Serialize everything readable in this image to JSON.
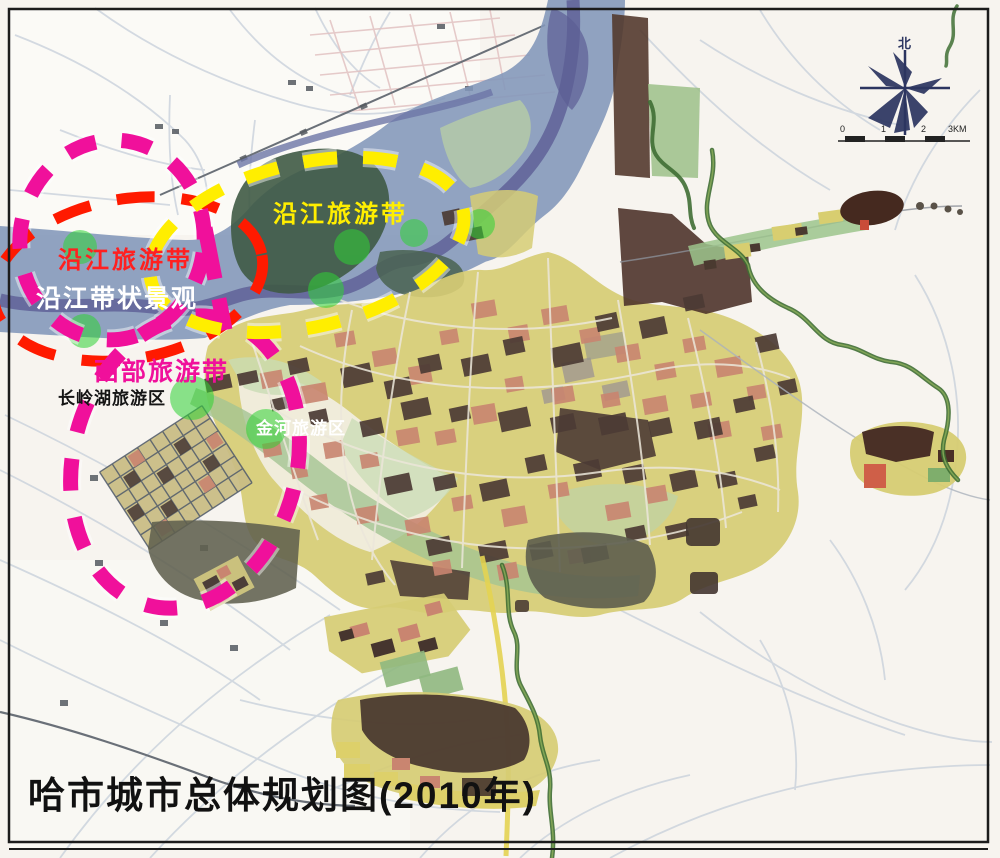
{
  "map": {
    "title": "哈市城市总体规划图(2010年)",
    "overlay_labels": {
      "riverside_yellow": "沿江旅游带",
      "riverside_red": "沿江旅游带",
      "riverside_landscape": "沿江带状景观",
      "western_belt": "西部旅游带",
      "changling_lake": "长岭湖旅游区",
      "jinhe": "金河旅游区"
    },
    "compass_north": "北",
    "scale_labels": [
      "0",
      "1",
      "2",
      "3KM"
    ],
    "colors": {
      "belt_magenta": "#F0109B",
      "belt_yellow": "#FFEE00",
      "belt_red": "#FF1A00",
      "spot_green": "#2FD335",
      "river_blue": "#8296B9"
    }
  }
}
